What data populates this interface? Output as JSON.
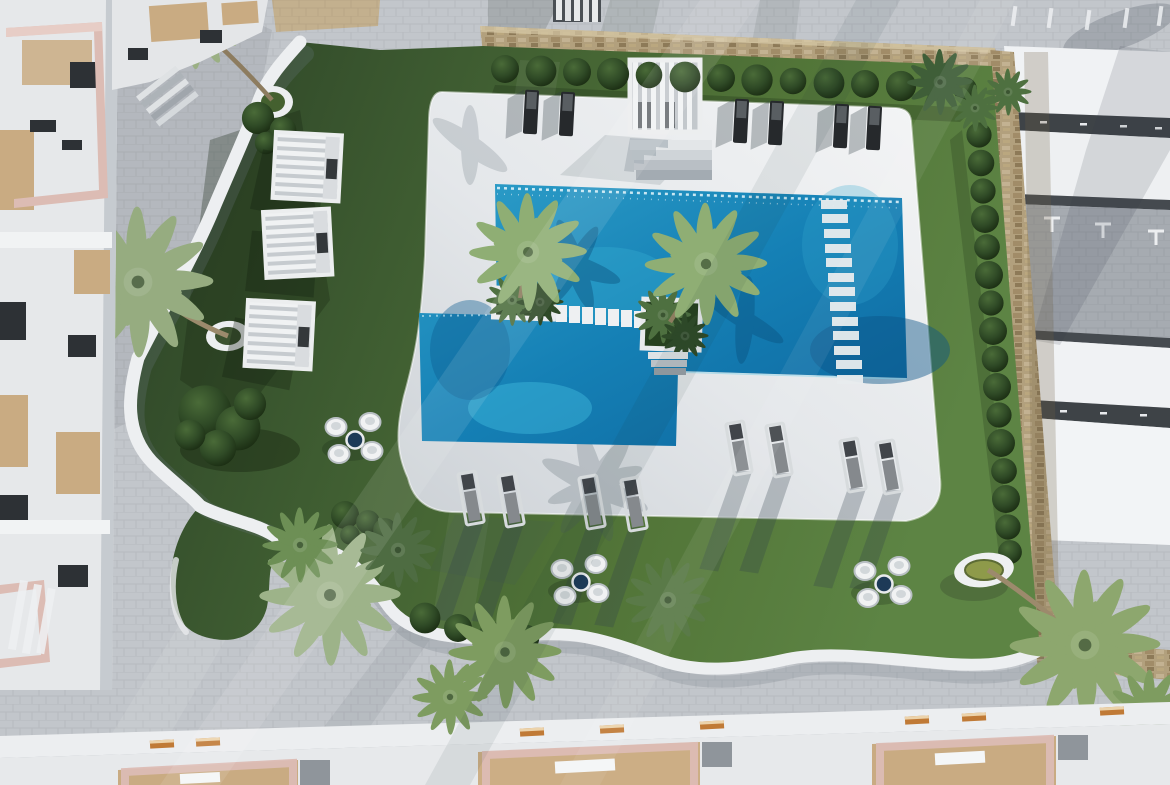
{
  "scene": {
    "type": "aerial-architectural-render",
    "setting": "top-down 3D render of a residential swimming-pool courtyard with gardens",
    "time_of_day": "sunny, long shadows toward bottom-left"
  },
  "colors": {
    "paving": "#c2c6cb",
    "paving_shade": "#a9aeb4",
    "deck_light": "#f4f5f6",
    "deck_mid": "#e4e7ea",
    "deck_shade": "#ccd1d6",
    "pool_light": "#2e9fc9",
    "pool_mid": "#1580b5",
    "pool_deep": "#0d669e",
    "pool_bright": "#45c4e4",
    "grass_dark": "#2b4126",
    "grass_mid": "#3e5c31",
    "grass_light": "#527538",
    "grass_bright": "#5d8444",
    "white_wall": "#edeff1",
    "stone": "#b2a07d",
    "stone_dark": "#94815f",
    "bush_dark": "#17280f",
    "bush_mid": "#2f4a26",
    "bush_light": "#4a6b38",
    "palm_light": "#9bb084",
    "palm_mid": "#6d8f55",
    "palm_dark": "#3f5e38",
    "lounger_dark": "#26292c",
    "lounger_gray": "#d7dbdd",
    "table_navy": "#1d3a57",
    "stool_white": "#f1f2f3",
    "pink_frame": "#dcbcb4",
    "wood": "#c9ab82",
    "bench_orange": "#c07a36",
    "beam_dark": "#3e4347",
    "panel_white": "#f0f2f4"
  },
  "objects": {
    "pool": {
      "count": 1,
      "shape": "L-shaped lagoon pool",
      "features": [
        "stepping-stone bridge",
        "in-water tile column along east side",
        "two island planters with palms",
        "beach-entry steps on north edge"
      ]
    },
    "cabanas_west_lawn": {
      "count": 3,
      "style": "white slatted-roof cubes"
    },
    "poolside_pergola_north": {
      "count": 1
    },
    "sun_loungers_north_row": {
      "count": 6
    },
    "sun_loungers_deck": {
      "count": 8
    },
    "bistro_sets": {
      "count": 3,
      "stools_each": 4
    },
    "round_planters": {
      "count": 3
    },
    "fountain_east": {
      "count": 1
    },
    "palm_trees": {
      "count": 12
    },
    "shrub_balls_north_row": {
      "count": 14
    },
    "shrub_balls_east_row": {
      "count": 16
    },
    "stone_wall_sides": "north and east perimeter",
    "buildings": [
      "west apartment rooftops with pink pergola frames",
      "south rooftop terraces with pink frames and timber decks",
      "east white roof panels with dark beams"
    ]
  }
}
